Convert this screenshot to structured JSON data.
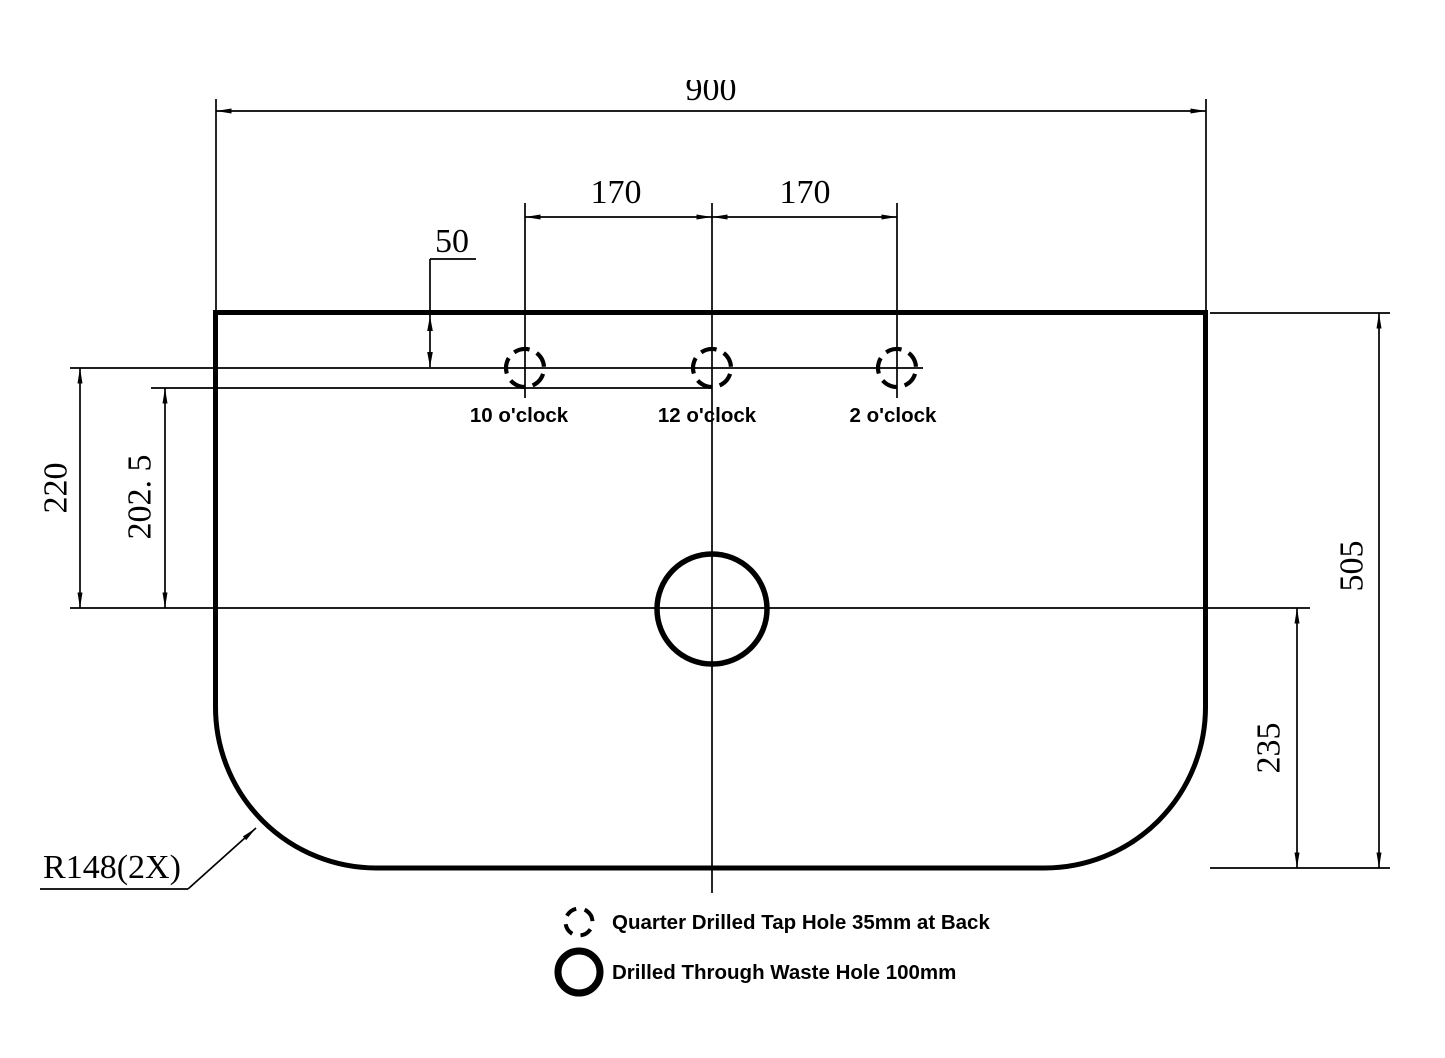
{
  "drawing": {
    "dimensions": {
      "overall_width": "900",
      "tap_spacing_left": "170",
      "tap_spacing_right": "170",
      "tap_hole_offset_from_top": "50",
      "tap_center_to_waste_center": "220",
      "tap_edge_to_waste_center": "202. 5",
      "overall_depth": "505",
      "waste_center_to_bottom": "235",
      "corner_radius": "R148(2X)"
    },
    "hole_labels": {
      "left": "10 o'clock",
      "center": "12 o'clock",
      "right": "2 o'clock"
    },
    "legend": {
      "tap_hole": "Quarter Drilled Tap Hole 35mm at Back",
      "waste_hole": "Drilled Through Waste Hole 100mm"
    },
    "colors": {
      "line": "#000000",
      "background": "#ffffff"
    }
  }
}
